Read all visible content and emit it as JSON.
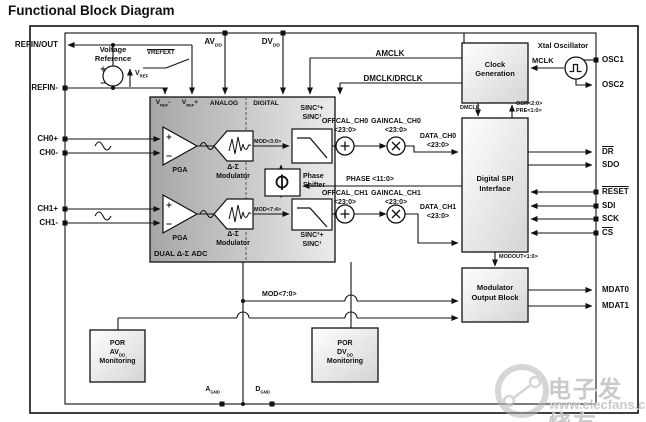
{
  "title": "Functional Block Diagram",
  "pins": {
    "refin_out": "REFIN/OUT",
    "refin_m": "REFIN-",
    "ch0p": "CH0+",
    "ch0m": "CH0-",
    "ch1p": "CH1+",
    "ch1m": "CH1-",
    "osc1": "OSC1",
    "osc2": "OSC2",
    "dr": "DR",
    "sdo": "SDO",
    "reset": "RESET",
    "sdi": "SDI",
    "sck": "SCK",
    "cs": "CS",
    "mdat0": "MDAT0",
    "mdat1": "MDAT1",
    "a": "A",
    "d": "D",
    "gnd": "GND",
    "av": "AV",
    "dv": "DV",
    "dd": "DD"
  },
  "reference": {
    "voltage": "Voltage",
    "reference": "Reference",
    "v": "V",
    "ref": "REF",
    "plus": "+",
    "minus": "-",
    "vrefext": "VREFEXT"
  },
  "adc": {
    "analog": "ANALOG",
    "digital": "DIGITAL",
    "pga": "PGA",
    "ds": "Δ-Σ",
    "modulator": "Modulator",
    "sinc3": "SINC³+",
    "sinc1": "SINC¹",
    "phase_l1": "Phase",
    "phase_l2": "Shifter",
    "dual": "DUAL Δ-Σ ADC"
  },
  "signals": {
    "mod30": "MOD<3:0>",
    "mod74": "MOD<7:4>",
    "mod70": "MOD<7:0>",
    "offcal_ch0": "OFFCAL_CH0",
    "gaincal_ch0": "GAINCAL_CH0",
    "offcal_ch1": "OFFCAL_CH1",
    "gaincal_ch1": "GAINCAL_CH1",
    "b23": "<23:0>",
    "data_ch0": "DATA_CH0",
    "data_ch1": "DATA_CH1",
    "phase11": "PHASE <11:0>",
    "amclk": "AMCLK",
    "dmclk_drclk": "DMCLK/DRCLK",
    "mclk": "MCLK",
    "dmclk": "DMCLK",
    "osr": "OSR<2:0>",
    "pre": "PRE<1:0>",
    "modout": "MODOUT<1:0>"
  },
  "blocks": {
    "clock_l1": "Clock",
    "clock_l2": "Generation",
    "xtal": "Xtal Oscillator",
    "spi_l1": "Digital SPI",
    "spi_l2": "Interface",
    "mob_l1": "Modulator",
    "mob_l2": "Output Block",
    "por": "POR",
    "monitoring": "Monitoring"
  },
  "watermark": {
    "cn": "电子发烧友",
    "url": "www.elecfans.com"
  }
}
